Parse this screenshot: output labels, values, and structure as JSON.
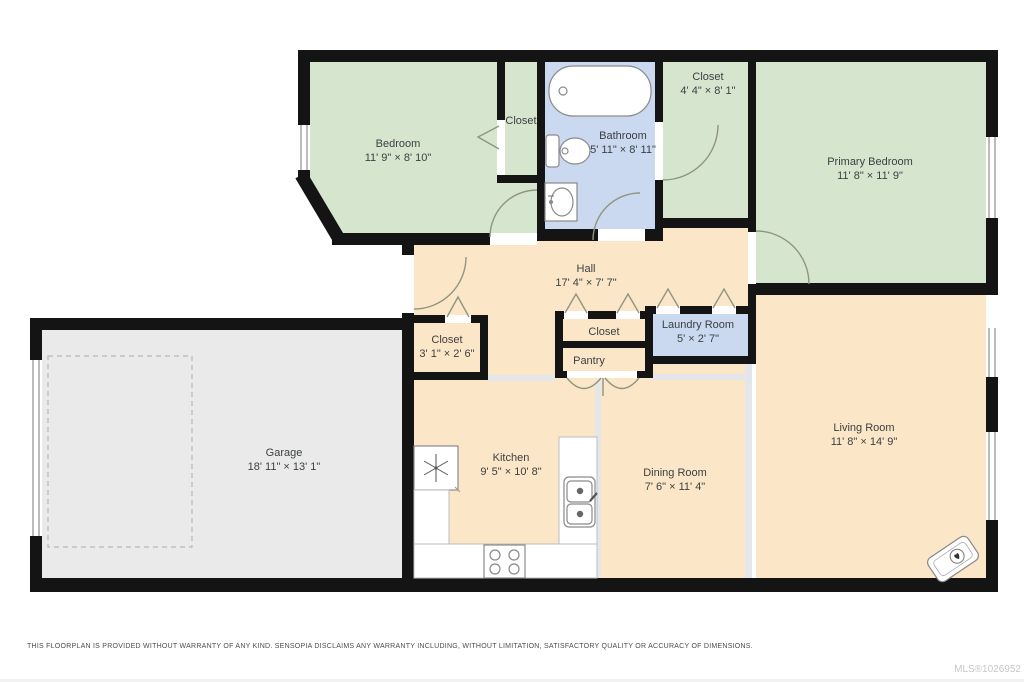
{
  "floorplan": {
    "rooms": [
      {
        "name": "Bedroom",
        "dims": "11' 9\" × 8' 10\""
      },
      {
        "name": "Closet"
      },
      {
        "name": "Bathroom",
        "dims": "5' 11\" × 8' 11\""
      },
      {
        "name": "Closet",
        "dims": "4' 4\" × 8' 1\""
      },
      {
        "name": "Primary Bedroom",
        "dims": "11' 8\" × 11' 9\""
      },
      {
        "name": "Hall",
        "dims": "17' 4\" × 7' 7\""
      },
      {
        "name": "Closet",
        "dims": "3' 1\" × 2' 6\""
      },
      {
        "name": "Closet"
      },
      {
        "name": "Pantry"
      },
      {
        "name": "Laundry Room",
        "dims": "5' × 2' 7\""
      },
      {
        "name": "Garage",
        "dims": "18' 11\" × 13' 1\""
      },
      {
        "name": "Kitchen",
        "dims": "9' 5\" × 10' 8\""
      },
      {
        "name": "Dining Room",
        "dims": "7' 6\" × 11' 4\""
      },
      {
        "name": "Living Room",
        "dims": "11' 8\" × 14' 9\""
      }
    ],
    "colors": {
      "wall": "#141414",
      "room_green": "#d6e5ce",
      "room_blue": "#cad8f0",
      "room_cream": "#fbe7c7",
      "garage_gray": "#eaeaea",
      "door_arc": "#8f9582"
    },
    "icons": [
      "bathtub-icon",
      "toilet-icon",
      "bath-sink-icon",
      "fridge-snowflake-icon",
      "stove-icon",
      "kitchen-sink-icon",
      "fireplace-icon",
      "garage-parking-dashed-outline"
    ]
  },
  "footer": {
    "disclaimer": "THIS FLOORPLAN IS PROVIDED WITHOUT WARRANTY OF ANY KIND. SENSOPIA DISCLAIMS ANY WARRANTY INCLUDING, WITHOUT LIMITATION, SATISFACTORY QUALITY OR ACCURACY OF DIMENSIONS.",
    "mls_id": "MLS®1026952"
  }
}
